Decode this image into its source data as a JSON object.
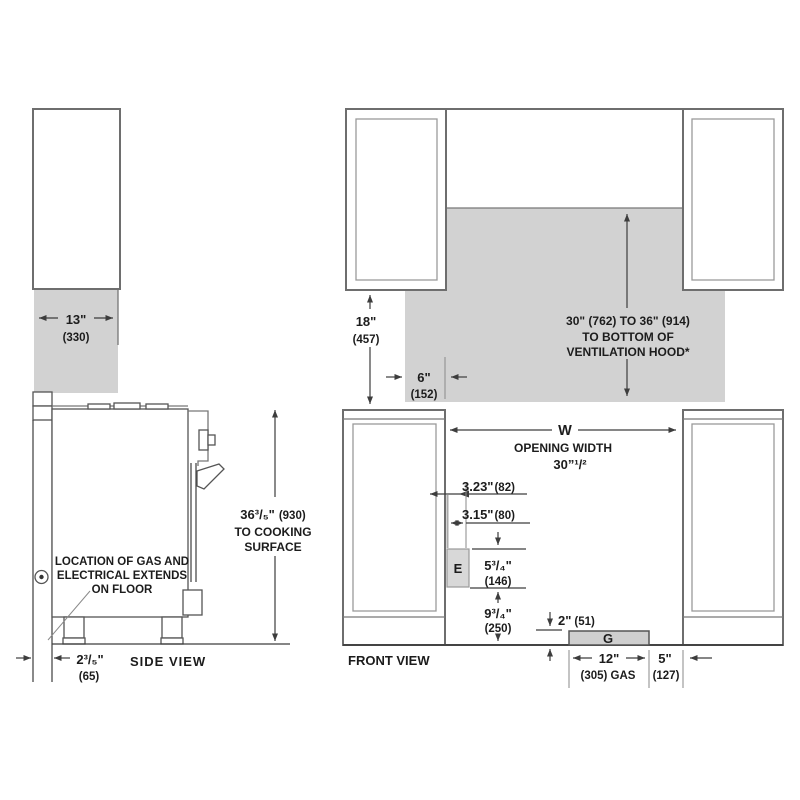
{
  "colors": {
    "shade_fill": "#d2d2d2",
    "line": "#3d3d3d",
    "cabinet_stroke": "#6e6e6e",
    "electrical_box_fill": "#d8d8d8",
    "gas_box_fill": "#cfcfcf",
    "text": "#1c1c1c"
  },
  "side_view": {
    "title": "SIDE VIEW",
    "cabinet_depth_in": "13\"",
    "cabinet_depth_mm": "(330)",
    "height_in": "36³/₅\"",
    "height_mm": "(930)",
    "height_line2": "TO COOKING",
    "height_line3": "SURFACE",
    "wall_gap_in": "2³/₅\"",
    "wall_gap_mm": "(65)",
    "note_line1": "LOCATION OF GAS AND",
    "note_line2": "ELECTRICAL EXTENDS",
    "note_line3": "ON FLOOR"
  },
  "front_view": {
    "title": "FRONT VIEW",
    "upper_height_in": "18\"",
    "upper_height_mm": "(457)",
    "hood_line1": "30\" (762) TO 36\" (914)",
    "hood_line2": "TO BOTTOM OF",
    "hood_line3": "VENTILATION HOOD*",
    "side_clearance_in": "6\"",
    "side_clearance_mm": "(152)",
    "opening_symbol": "W",
    "opening_label": "OPENING WIDTH",
    "opening_value": "30”¹/²",
    "elec_offset_top_in": "3.23\"",
    "elec_offset_top_mm": "(82)",
    "elec_offset_in": "3.15\"",
    "elec_offset_mm": "(80)",
    "electrical_symbol": "E",
    "elec_height_in": "5³/₄\"",
    "elec_height_mm": "(146)",
    "elec_floor_in": "9³/₄\"",
    "elec_floor_mm": "(250)",
    "gas_height_in": "2\"",
    "gas_height_mm": "(51)",
    "gas_symbol": "G",
    "gas_width_in": "12\"",
    "gas_width_mm": "(305) GAS",
    "gas_right_in": "5\"",
    "gas_right_mm": "(127)"
  }
}
